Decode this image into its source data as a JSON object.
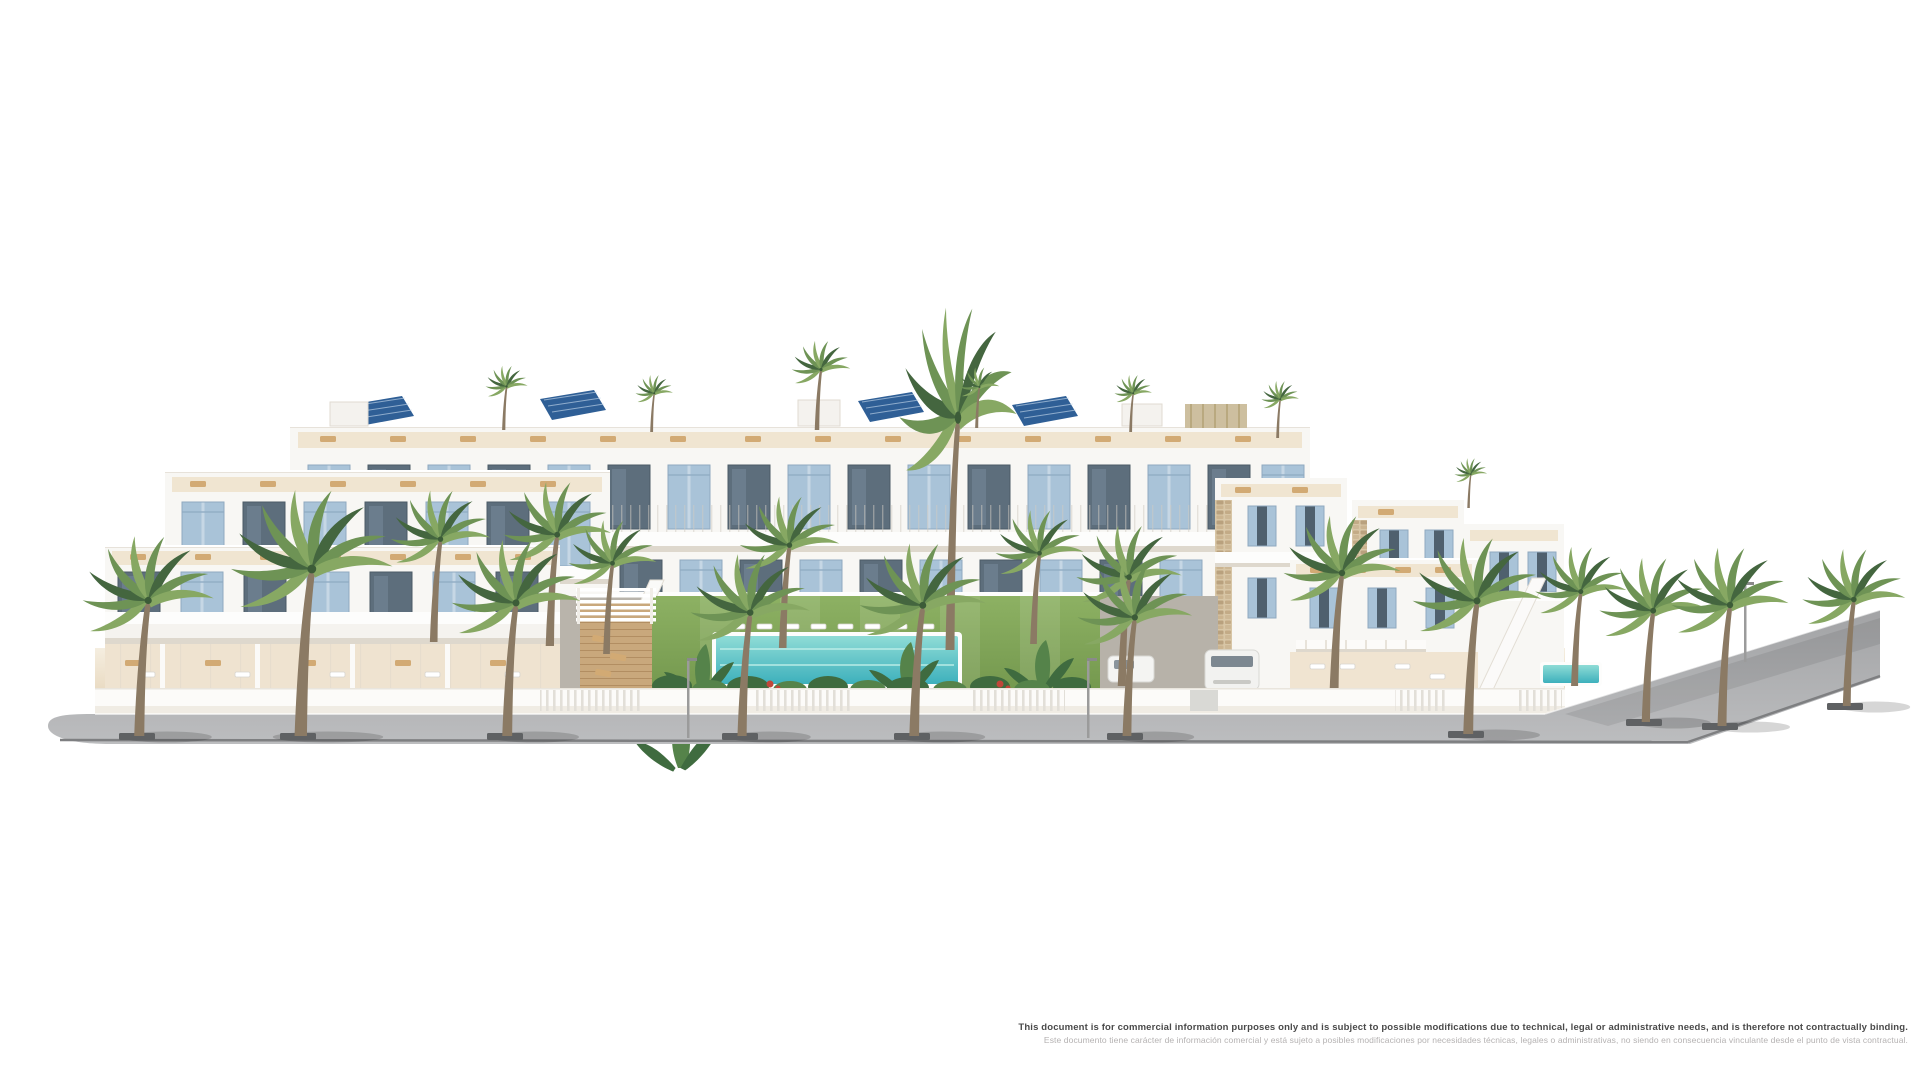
{
  "meta": {
    "canvas_width": 1920,
    "canvas_height": 1080,
    "background": "#ffffff",
    "description": "Aerial 3D architectural render of a white Mediterranean residential complex with stepped roof-terrace apartments, villas, communal lawn and pool, wrap-around grey street and palm trees"
  },
  "disclaimer": {
    "en": "This document is for commercial information purposes only and is subject to possible modifications due to technical, legal or administrative needs, and is therefore not contractually binding.",
    "es": "Este documento tiene carácter de información comercial y está sujeto a posibles modificaciones por necesidades técnicas, legales o administrativas, no siendo en consecuencia vinculante desde el punto de vista contractual."
  },
  "scene": {
    "colors": {
      "trunk": "#8b7a64",
      "palm-dark": "#44663f",
      "palm-mid": "#6e9355",
      "palm-light": "#87a863",
      "shutter": "#a9c3d8",
      "glass": "#5d6e7c",
      "white": "#f8f7f4",
      "white-bright": "#fdfdfc",
      "shadow-warm": "#ded8cd",
      "sand": "#f0e5d1",
      "sand-deep": "#e9dac1",
      "road-a": "#a5a6a8",
      "road-b": "#bcbdbf",
      "curb": "#7e7f81",
      "stone": "#cdb48e",
      "wood": "#c9a87c",
      "lawn-a": "#8db163",
      "lawn-b": "#74984e",
      "pool-a": "#8fdcd6",
      "pool-b": "#3db0bc",
      "plant-dark": "#3f6b3f",
      "plant-mid": "#55834a",
      "flower": "#c0463a",
      "solar": "#2f5f96",
      "text-dark": "#4a4a4a",
      "text-light": "#b5b2b2"
    },
    "palms": [
      {
        "x": 137,
        "y": 736,
        "s": 1.12,
        "layer": "front"
      },
      {
        "x": 298,
        "y": 736,
        "s": 1.38,
        "layer": "front"
      },
      {
        "x": 505,
        "y": 736,
        "s": 1.1,
        "layer": "front"
      },
      {
        "x": 740,
        "y": 736,
        "s": 1.02,
        "layer": "front"
      },
      {
        "x": 912,
        "y": 736,
        "s": 1.08,
        "layer": "front"
      },
      {
        "x": 1125,
        "y": 736,
        "s": 0.98,
        "layer": "front"
      },
      {
        "x": 1466,
        "y": 734,
        "s": 1.1,
        "layer": "front"
      },
      {
        "x": 1644,
        "y": 722,
        "s": 0.92,
        "layer": "front"
      },
      {
        "x": 1720,
        "y": 726,
        "s": 1.0,
        "layer": "front"
      },
      {
        "x": 1845,
        "y": 706,
        "s": 0.88,
        "layer": "front"
      },
      {
        "x": 432,
        "y": 642,
        "s": 0.85,
        "layer": "mid"
      },
      {
        "x": 548,
        "y": 646,
        "s": 0.92,
        "layer": "mid"
      },
      {
        "x": 605,
        "y": 654,
        "s": 0.75,
        "layer": "mid"
      },
      {
        "x": 781,
        "y": 648,
        "s": 0.85,
        "layer": "mid"
      },
      {
        "x": 948,
        "y": 650,
        "s": 1.0,
        "sy": 1.92,
        "layer": "mid"
      },
      {
        "x": 1032,
        "y": 644,
        "s": 0.75,
        "layer": "mid"
      },
      {
        "x": 1120,
        "y": 686,
        "s": 0.9,
        "layer": "mid"
      },
      {
        "x": 1332,
        "y": 694,
        "s": 1.0,
        "layer": "mid"
      },
      {
        "x": 1573,
        "y": 686,
        "s": 0.78,
        "layer": "mid"
      },
      {
        "x": 503,
        "y": 430,
        "s": 0.36,
        "layer": "mid"
      },
      {
        "x": 651,
        "y": 432,
        "s": 0.32,
        "layer": "mid"
      },
      {
        "x": 816,
        "y": 430,
        "s": 0.5,
        "layer": "mid"
      },
      {
        "x": 976,
        "y": 428,
        "s": 0.34,
        "layer": "mid"
      },
      {
        "x": 1130,
        "y": 432,
        "s": 0.32,
        "layer": "mid"
      },
      {
        "x": 1277,
        "y": 438,
        "s": 0.32,
        "layer": "mid"
      },
      {
        "x": 1468,
        "y": 508,
        "s": 0.28,
        "layer": "mid"
      }
    ]
  }
}
